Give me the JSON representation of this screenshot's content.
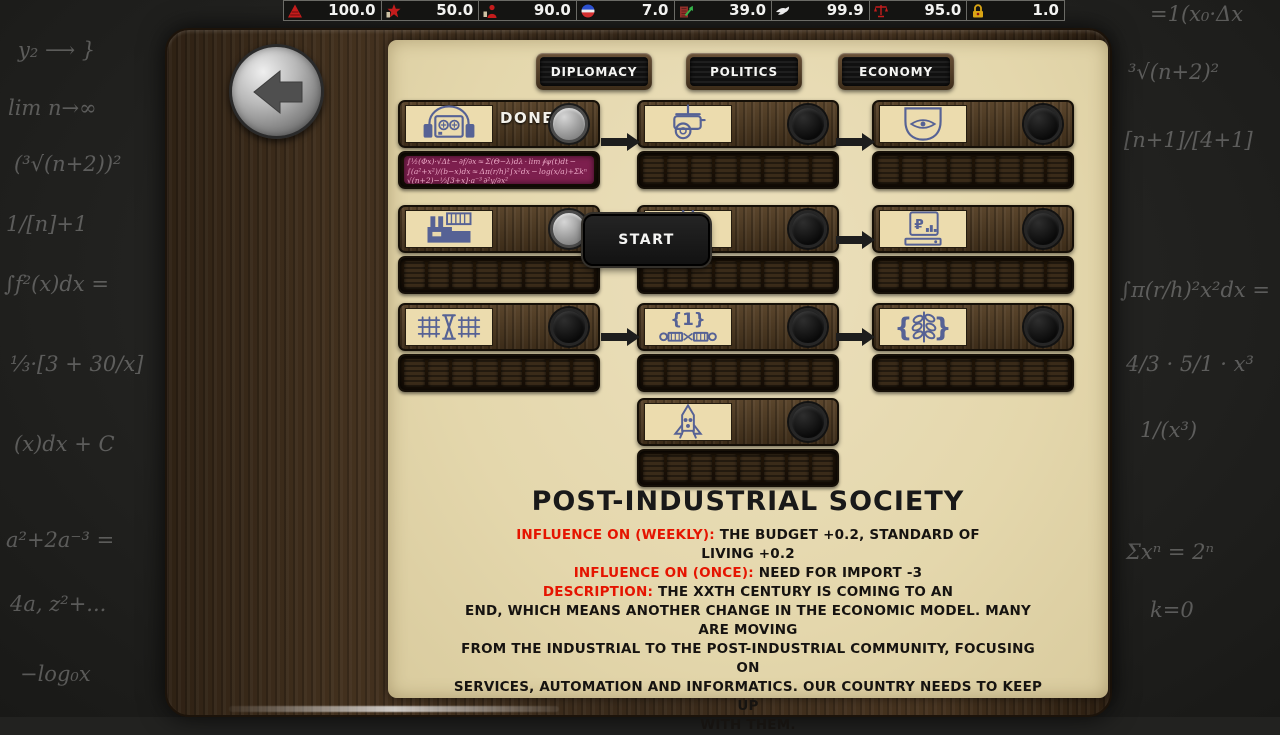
{
  "top_bar": {
    "stats": [
      {
        "icon": "energy-pyramid-icon",
        "value": "100.0"
      },
      {
        "icon": "party-star-icon",
        "value": "50.0"
      },
      {
        "icon": "population-support-icon",
        "value": "90.0"
      },
      {
        "icon": "faction-roundel-icon",
        "value": "7.0"
      },
      {
        "icon": "economy-building-icon",
        "value": "39.0"
      },
      {
        "icon": "peace-dove-icon",
        "value": "99.9"
      },
      {
        "icon": "justice-scales-icon",
        "value": "95.0"
      },
      {
        "icon": "security-lock-icon",
        "value": "1.0"
      }
    ]
  },
  "back_button": {
    "icon": "back-arrow-icon"
  },
  "tabs": [
    {
      "label": "DIPLOMACY"
    },
    {
      "label": "POLITICS"
    },
    {
      "label": "ECONOMY"
    }
  ],
  "start_button": {
    "label": "START"
  },
  "tech_tree": {
    "nodes": [
      {
        "icon": "radio-receiver-icon",
        "status": "done",
        "status_label": "DONE",
        "segments": 8,
        "filled": 8
      },
      {
        "icon": "surveillance-camera-icon",
        "status": "locked",
        "segments": 8,
        "filled": 0
      },
      {
        "icon": "monitor-eye-icon",
        "status": "locked",
        "segments": 8,
        "filled": 0
      },
      {
        "icon": "factory-icon",
        "status": "available",
        "segments": 8,
        "filled": 0
      },
      {
        "icon": "pylon-icon",
        "status": "locked",
        "segments": 8,
        "filled": 0
      },
      {
        "icon": "computer-ruble-icon",
        "status": "locked",
        "segments": 8,
        "filled": 0
      },
      {
        "icon": "space-station-icon",
        "status": "locked",
        "segments": 8,
        "filled": 0
      },
      {
        "icon": "connectors-icon",
        "status": "locked",
        "segments": 8,
        "filled": 0
      },
      {
        "icon": "wheat-icon",
        "status": "locked",
        "segments": 8,
        "filled": 0
      },
      {
        "icon": "rocket-icon",
        "status": "locked",
        "segments": 8,
        "filled": 0
      }
    ],
    "research_fill_text": {
      "line1": "∫½(Φx)·√Δt − ∂f/∂x ≈ Σ(Θ−λ)dλ · lim ∮ψ(t)dt − ∫(a²+x²)/(b−x)dx ≈ Δπ(r/h)²∫x²dx − log(x/a)+Σkⁿ √(n+2)−⅓[3+x]·a⁻³ ∂²y/∂x²",
      "line2": "≈ π(r/h)² ∫x²dx − log(x/a) + Σ kⁿ ½∮(Θ−λ)dλ √(n+2) − ⅓[3+x]·(a⁻³) ∂²y/∂x² lim ∮ψ(t)dt ∫(a²+x²)dx"
    }
  },
  "details": {
    "title": "POST-INDUSTRIAL SOCIETY",
    "sections": [
      {
        "label": "INFLUENCE ON (WEEKLY):",
        "lines": [
          "THE BUDGET +0.2, STANDARD OF",
          "LIVING +0.2"
        ]
      },
      {
        "label": "INFLUENCE ON (ONCE):",
        "lines": [
          "NEED FOR IMPORT -3"
        ]
      },
      {
        "label": "DESCRIPTION:",
        "lines": [
          "THE XXTH CENTURY IS COMING TO AN",
          "END, WHICH MEANS ANOTHER CHANGE IN THE ECONOMIC MODEL. MANY ARE MOVING",
          "FROM THE INDUSTRIAL TO THE POST-INDUSTRIAL COMMUNITY, FOCUSING ON",
          "SERVICES, AUTOMATION AND INFORMATICS. OUR COUNTRY NEEDS TO KEEP UP",
          "WITH THEM."
        ]
      }
    ]
  },
  "bg": {
    "formulas": [
      "y₂ ⟶ }",
      "lim n→∞",
      "(³√(n+2))²",
      "1/[n]+1",
      "∫f²(x)dx =",
      "⅓·[3 + 30/x]",
      "(x)dx + C",
      "a²+2a⁻³ =",
      "4a, z²+...",
      "−log₀x",
      "³√(n+2)²",
      "[n+1]/[4+1]",
      "∫π(r/h)²x²dx =",
      "4/3 · 5/1 · x³",
      "1/(x³)",
      "Σxⁿ = 2ⁿ",
      "k=0",
      "=1(x₀·Δx"
    ]
  }
}
